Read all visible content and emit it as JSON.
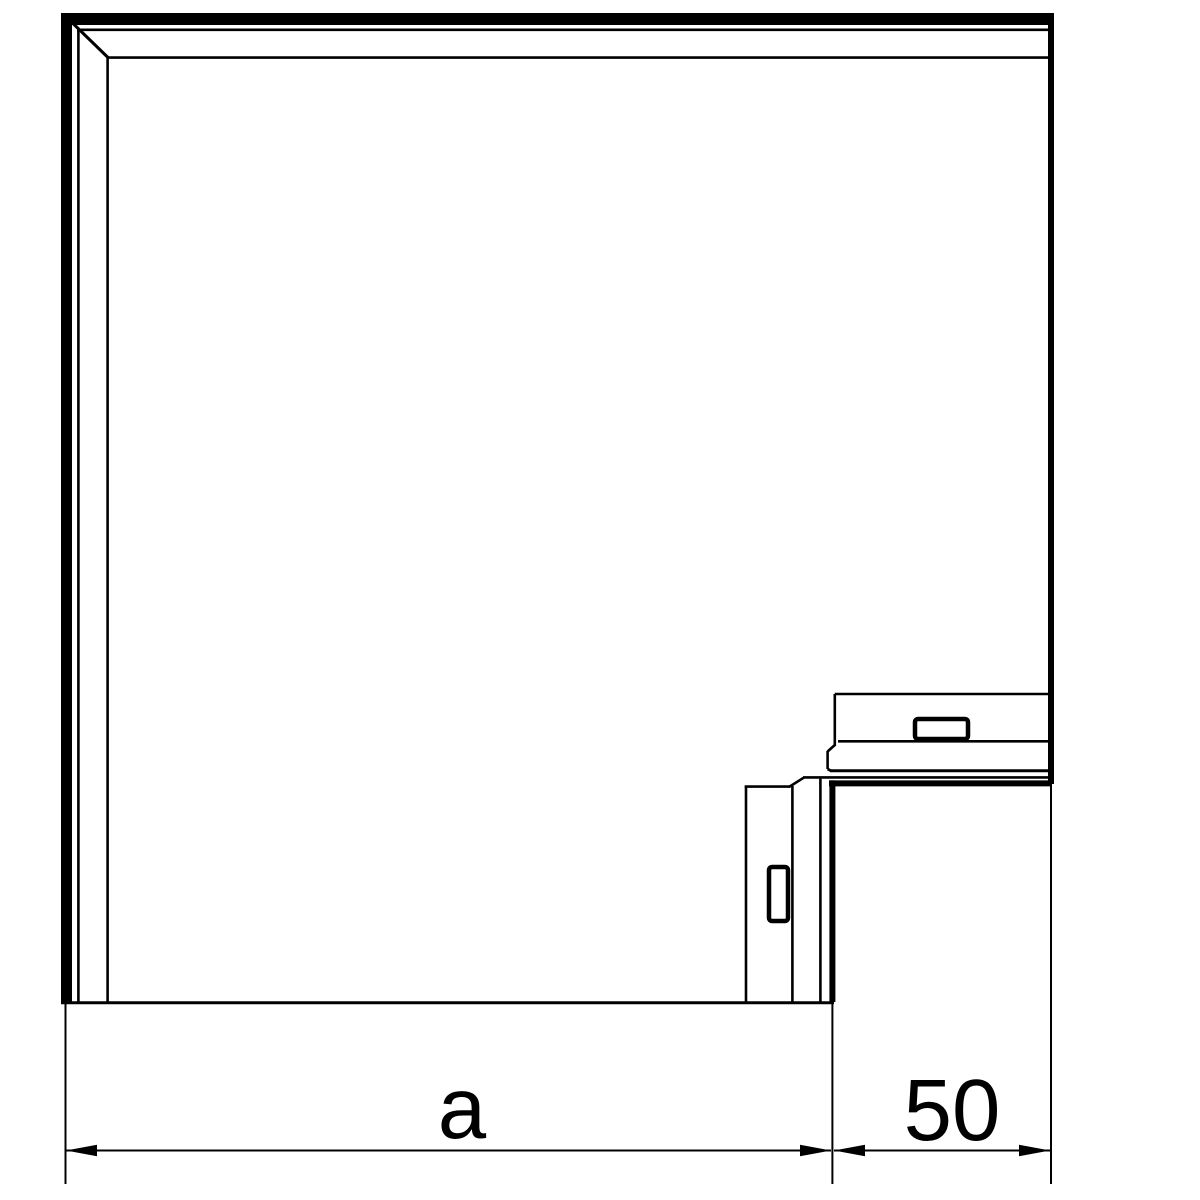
{
  "drawing": {
    "background_color": "#ffffff",
    "line_color": "#000000",
    "labels": {
      "dim_a": "a",
      "dim_50": "50"
    },
    "geometry": {
      "segments": [
        {
          "x1": 61,
          "y1": 19,
          "x2": 1054,
          "y2": 19,
          "w": 12,
          "part": "cover-top-outer-band"
        },
        {
          "x1": 66.5,
          "y1": 13,
          "x2": 66.5,
          "y2": 1003,
          "w": 11,
          "part": "cover-left-outer-band"
        },
        {
          "x1": 77,
          "y1": 29.8,
          "x2": 1049,
          "y2": 29.8,
          "w": 2.6,
          "part": "cover-top-thin-line"
        },
        {
          "x1": 78.4,
          "y1": 29,
          "x2": 78.4,
          "y2": 1002,
          "w": 2.6,
          "part": "cover-left-thin-line"
        },
        {
          "x1": 108,
          "y1": 57.6,
          "x2": 1049,
          "y2": 57.6,
          "w": 2.6,
          "part": "cover-top-inner-line"
        },
        {
          "x1": 107.6,
          "y1": 57,
          "x2": 107.6,
          "y2": 1002,
          "w": 2.6,
          "part": "cover-left-inner-line"
        },
        {
          "x1": 73.5,
          "y1": 24,
          "x2": 109,
          "y2": 58.5,
          "w": 3,
          "part": "corner-miter-diagonal"
        },
        {
          "x1": 1051,
          "y1": 13,
          "x2": 1051,
          "y2": 784,
          "w": 6,
          "part": "cover-right-edge-band"
        },
        {
          "x1": 61,
          "y1": 1002.8,
          "x2": 834,
          "y2": 1002.8,
          "w": 3,
          "part": "cover-bottom-edge"
        },
        {
          "x1": 834.8,
          "y1": 694,
          "x2": 1051,
          "y2": 694,
          "w": 2.6,
          "part": "flange-top-edge"
        },
        {
          "x1": 834.8,
          "y1": 694,
          "x2": 834.8,
          "y2": 746,
          "w": 2.6,
          "part": "flange-left-edge"
        },
        {
          "x1": 834.8,
          "y1": 745,
          "x2": 827.6,
          "y2": 751.5,
          "w": 2.6,
          "part": "flange-left-chamfer"
        },
        {
          "x1": 827.6,
          "y1": 751,
          "x2": 827.6,
          "y2": 769,
          "w": 2.6,
          "part": "flange-step-vertical"
        },
        {
          "x1": 838,
          "y1": 741.3,
          "x2": 1051,
          "y2": 741.3,
          "w": 2.6,
          "part": "flange-ledge-line"
        },
        {
          "x1": 827.6,
          "y1": 769,
          "x2": 831,
          "y2": 770.8,
          "w": 2.8,
          "part": "flange-corner-join"
        },
        {
          "x1": 830,
          "y1": 770.8,
          "x2": 1051,
          "y2": 770.8,
          "w": 3,
          "part": "flange-bottom-edge"
        },
        {
          "x1": 803,
          "y1": 777.4,
          "x2": 1051,
          "y2": 777.4,
          "w": 2.6,
          "part": "inner-corner-thin-horizontal"
        },
        {
          "x1": 829,
          "y1": 783.4,
          "x2": 1051,
          "y2": 783.4,
          "w": 6,
          "part": "inner-corner-thick-horizontal"
        },
        {
          "x1": 820.4,
          "y1": 778.6,
          "x2": 820.4,
          "y2": 1002,
          "w": 2.6,
          "part": "inner-corner-thin-vertical"
        },
        {
          "x1": 832.4,
          "y1": 780.4,
          "x2": 832.4,
          "y2": 1002,
          "w": 6,
          "part": "inner-corner-thick-vertical"
        },
        {
          "x1": 746,
          "y1": 785.6,
          "x2": 746,
          "y2": 1002,
          "w": 2.6,
          "part": "lower-piece-left-edge"
        },
        {
          "x1": 744.7,
          "y1": 786.6,
          "x2": 790,
          "y2": 786.6,
          "w": 2.6,
          "part": "lower-piece-top-edge"
        },
        {
          "x1": 789,
          "y1": 787,
          "x2": 803.5,
          "y2": 777.8,
          "w": 2.6,
          "part": "lower-piece-bevel"
        },
        {
          "x1": 792.4,
          "y1": 786,
          "x2": 792.4,
          "y2": 1002,
          "w": 2.6,
          "part": "lower-piece-inner-line"
        },
        {
          "x1": 65.5,
          "y1": 1004,
          "x2": 65.5,
          "y2": 1184,
          "w": 2,
          "part": "extension-line-left"
        },
        {
          "x1": 832.4,
          "y1": 1004,
          "x2": 832.4,
          "y2": 1184,
          "w": 2,
          "part": "extension-line-middle"
        },
        {
          "x1": 1051,
          "y1": 784,
          "x2": 1051,
          "y2": 1184,
          "w": 2,
          "part": "extension-line-right"
        },
        {
          "x1": 66,
          "y1": 1150.5,
          "x2": 831,
          "y2": 1150.5,
          "w": 2,
          "part": "dimension-line-a"
        },
        {
          "x1": 834,
          "y1": 1150.5,
          "x2": 1050,
          "y2": 1150.5,
          "w": 2,
          "part": "dimension-line-50"
        }
      ],
      "rects": [
        {
          "x": 915,
          "y": 719,
          "w": 53,
          "h": 20,
          "rx": 3,
          "sw": 4.5,
          "part": "flange-latch"
        },
        {
          "x": 769,
          "y": 867,
          "w": 19,
          "h": 54,
          "rx": 3,
          "sw": 4.5,
          "part": "lower-piece-latch"
        }
      ],
      "polygons": [
        {
          "points": "66,1150.5 97,1144.8 97,1156.2",
          "part": "arrowhead-a-left"
        },
        {
          "points": "831,1150.5 800,1144.8 800,1156.2",
          "part": "arrowhead-a-right"
        },
        {
          "points": "834,1150.5 865,1144.8 865,1156.2",
          "part": "arrowhead-50-left"
        },
        {
          "points": "1050,1150.5 1019,1144.8 1019,1156.2",
          "part": "arrowhead-50-right"
        }
      ]
    }
  }
}
